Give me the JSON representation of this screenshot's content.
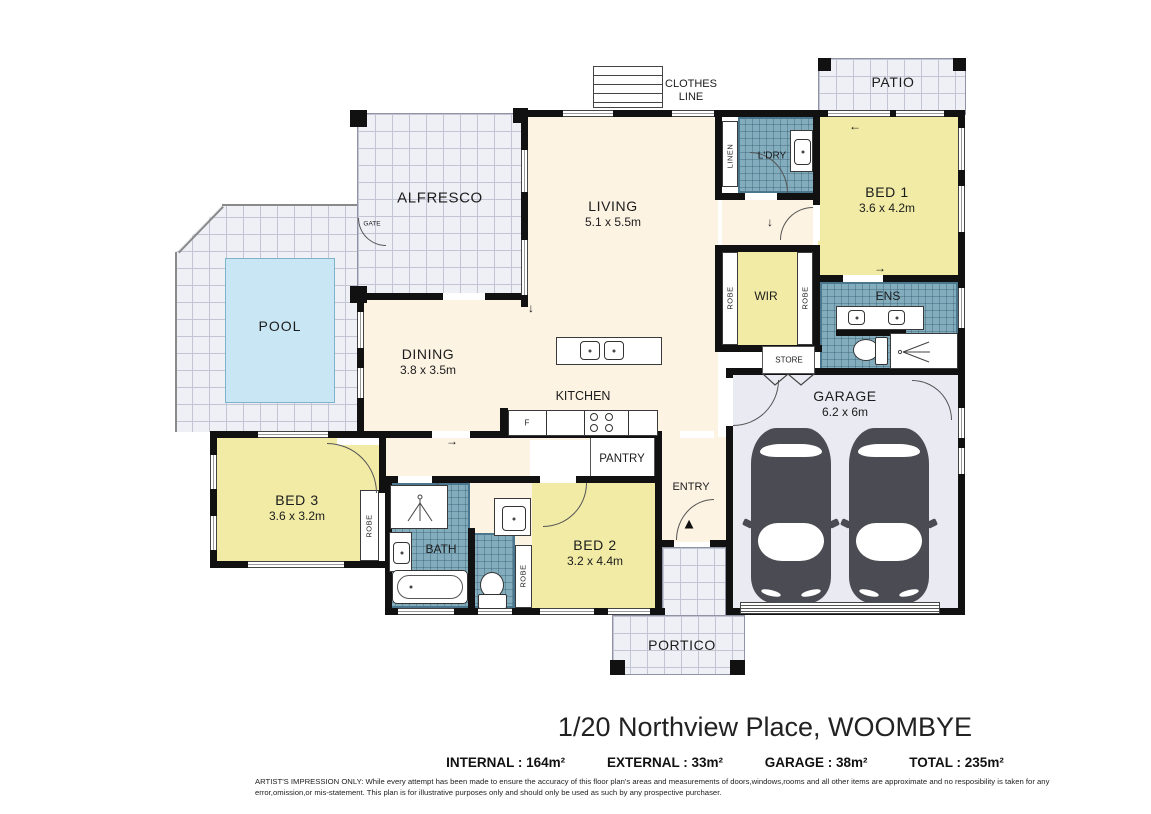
{
  "rooms": {
    "patio": {
      "name": "PATIO"
    },
    "alfresco": {
      "name": "ALFRESCO"
    },
    "living": {
      "name": "LIVING",
      "dims": "5.1 x 5.5m"
    },
    "dining": {
      "name": "DINING",
      "dims": "3.8 x 3.5m"
    },
    "kitchen": {
      "name": "KITCHEN"
    },
    "pantry": {
      "name": "PANTRY"
    },
    "pool": {
      "name": "POOL"
    },
    "bed1": {
      "name": "BED 1",
      "dims": "3.6 x 4.2m"
    },
    "bed2": {
      "name": "BED 2",
      "dims": "3.2 x 4.4m"
    },
    "bed3": {
      "name": "BED 3",
      "dims": "3.6 x 3.2m"
    },
    "garage": {
      "name": "GARAGE",
      "dims": "6.2 x 6m"
    },
    "wir": {
      "name": "WIR"
    },
    "ens": {
      "name": "ENS"
    },
    "bath": {
      "name": "BATH"
    },
    "laundry": {
      "name": "L'DRY"
    },
    "portico": {
      "name": "PORTICO"
    }
  },
  "labels": {
    "clothes_line_1": "CLOTHES",
    "clothes_line_2": "LINE",
    "linen": "LINEN",
    "robe": "ROBE",
    "store": "STORE",
    "gate": "GATE",
    "entry": "ENTRY",
    "fridge": "F"
  },
  "icons": {
    "entry_arrow": "▲",
    "arrow_left": "←",
    "arrow_right": "→",
    "arrow_down": "↓"
  },
  "footer": {
    "title": "1/20 Northview Place, WOOMBYE",
    "summary": [
      "INTERNAL : 164m²",
      "EXTERNAL : 33m²",
      "GARAGE : 38m²",
      "TOTAL : 235m²"
    ],
    "disclaimer": "ARTIST'S IMPRESSION ONLY: While every attempt has been made to ensure the accuracy of this floor plan's areas and measurements of doors,windows,rooms and all other items are approximate and no resposibility is taken for any error,omission,or mis-statement. This plan is for illustrative purposes only and should only be used as such by any prospective purchaser."
  },
  "colors": {
    "wall": "#111111",
    "bedroom_fill": "#f1eba6",
    "living_fill": "#fcf3e3",
    "wet_area_fill": "#83acbc",
    "outdoor_fill": "#eef0f6",
    "garage_fill": "#e9eaf2",
    "pool_fill": "#c9e6f5",
    "car": "#4b4b53"
  }
}
